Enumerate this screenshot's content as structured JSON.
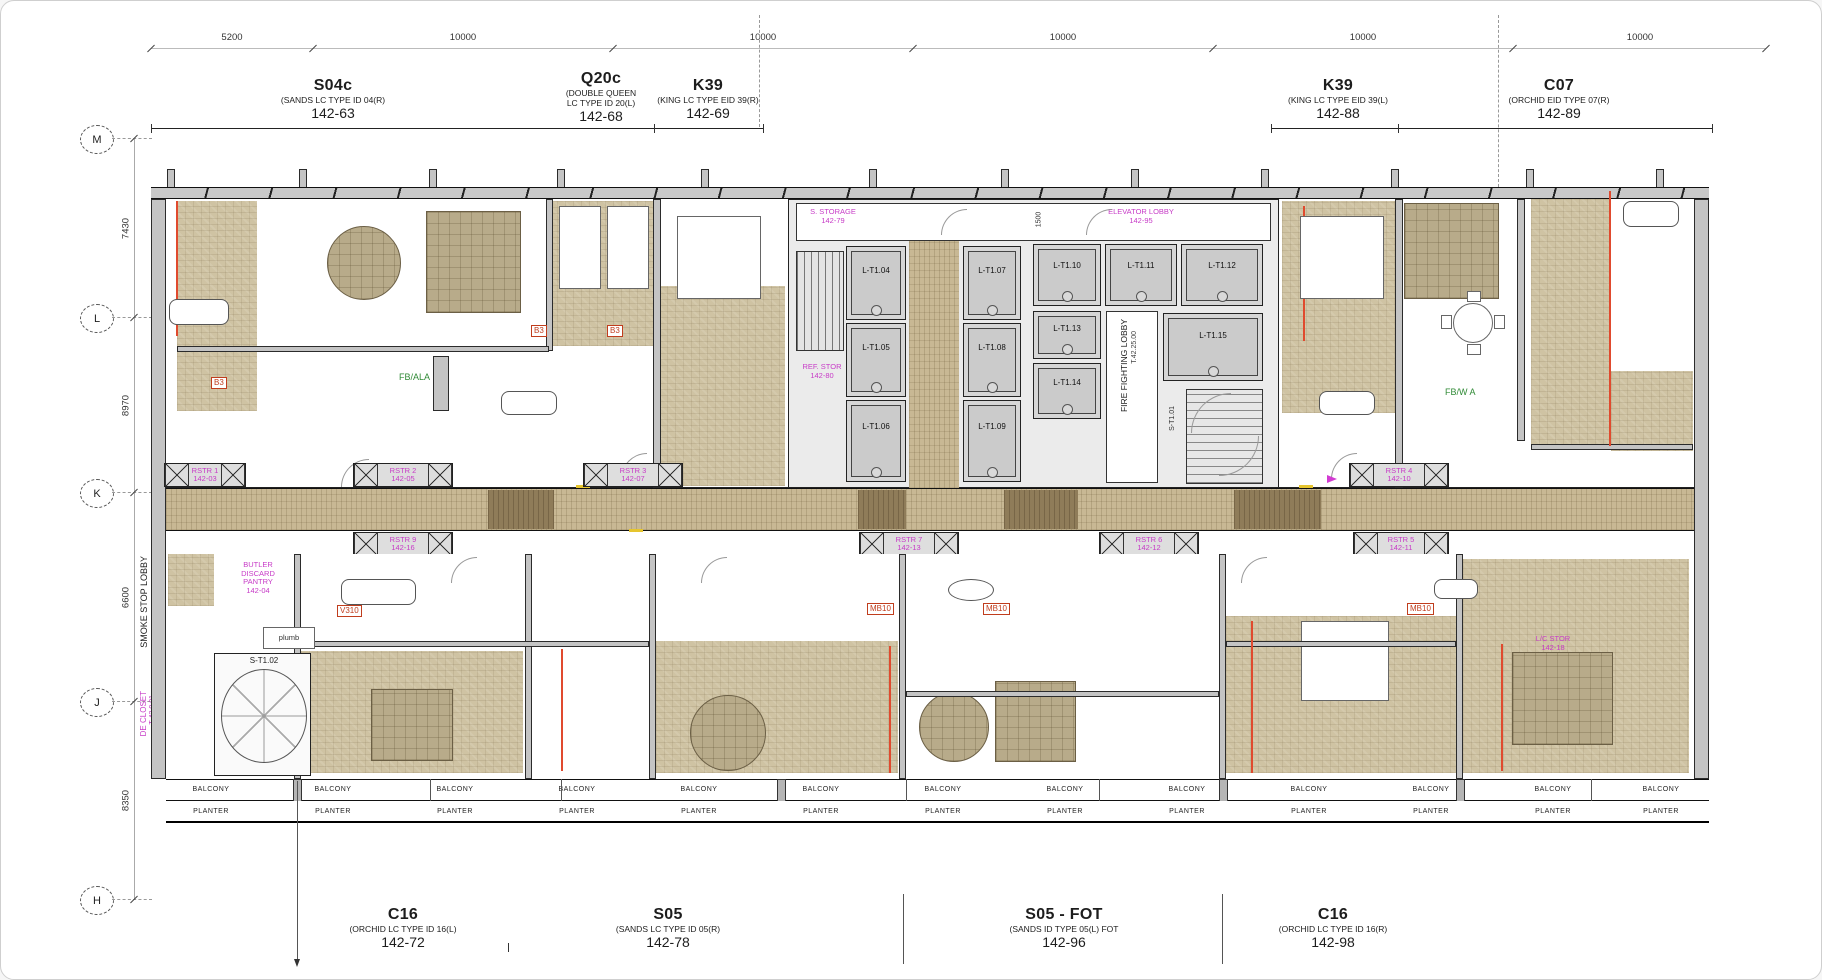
{
  "sheet": {
    "background": "#ffffff",
    "border_color": "#cfcfcf"
  },
  "palette": {
    "carpet": "#cfc3a3",
    "corridor": "#c8b894",
    "corridor_dark": "#8f7c59",
    "rug": "#b8ab8a",
    "wall_gray": "#c4c4c4",
    "red_line": "#e04a2e",
    "tag_red": "#c03d1d",
    "magenta": "#c73bc7",
    "green": "#2f8a35"
  },
  "top_dims": {
    "values": [
      "5200",
      "10000",
      "10000",
      "10000",
      "10000",
      "10000"
    ]
  },
  "left_dims": {
    "values": [
      "7430",
      "8970",
      "6600",
      "8350"
    ]
  },
  "grid": {
    "rows": [
      "M",
      "L",
      "K",
      "J",
      "H"
    ]
  },
  "units_top": [
    {
      "code": "S04c",
      "desc": "(SANDS LC TYPE ID 04(R)",
      "num": "142-63"
    },
    {
      "code": "Q20c",
      "desc": "(DOUBLE QUEEN",
      "desc2": "LC TYPE ID 20(L)",
      "num": "142-68"
    },
    {
      "code": "K39",
      "desc": "(KING LC TYPE EID 39(R)",
      "num": "142-69"
    },
    {
      "code": "K39",
      "desc": "(KING LC TYPE EID 39(L)",
      "num": "142-88"
    },
    {
      "code": "C07",
      "desc": "(ORCHID EID TYPE 07(R)",
      "num": "142-89"
    }
  ],
  "units_bottom": [
    {
      "code": "C16",
      "desc": "(ORCHID LC TYPE ID 16(L)",
      "num": "142-72"
    },
    {
      "code": "S05",
      "desc": "(SANDS LC TYPE ID 05(R)",
      "num": "142-78"
    },
    {
      "code": "S05 - FOT",
      "desc": "(SANDS ID TYPE 05(L) FOT",
      "num": "142-96"
    },
    {
      "code": "C16",
      "desc": "(ORCHID LC TYPE ID 16(R)",
      "num": "142-98"
    }
  ],
  "strips": {
    "balcony": "BALCONY",
    "planter": "PLANTER"
  },
  "risers": [
    {
      "name": "RSTR 1",
      "num": "142-03"
    },
    {
      "name": "RSTR 2",
      "num": "142-05"
    },
    {
      "name": "RSTR 3",
      "num": "142-07"
    },
    {
      "name": "RSTR 4",
      "num": "142-10"
    },
    {
      "name": "RSTR 9",
      "num": "142-16"
    },
    {
      "name": "RSTR 7",
      "num": "142-13"
    },
    {
      "name": "RSTR 6",
      "num": "142-12"
    },
    {
      "name": "RSTR 5",
      "num": "142-11"
    }
  ],
  "core": {
    "lifts": [
      "L-T1.04",
      "L-T1.05",
      "L-T1.06",
      "L-T1.07",
      "L-T1.08",
      "L-T1.09",
      "L-T1.10",
      "L-T1.11",
      "L-T1.12",
      "L-T1.13",
      "L-T1.14",
      "L-T1.15"
    ],
    "storage": "S. STORAGE",
    "storage_num": "142-79",
    "elevator_lobby": "ELEVATOR LOBBY",
    "elevator_lobby_num": "142-95",
    "fire_lobby": "FIRE FIGHTING LOBBY",
    "fire_lobby_id": "T.42.25.00",
    "ref_store": "REF. STOR",
    "ref_store_num": "142-80",
    "stair_right": "S-T1.01",
    "dim_1500": "1500"
  },
  "annotations": {
    "smoke_lobby": "SMOKE STOP LOBBY",
    "smoke_lobby_id": "T.42.22.00",
    "de_closet": "DE CLOSET",
    "de_closet_id": "T-42.0.01",
    "butler1": "BUTLER",
    "butler2": "DISCARD",
    "butler3": "PANTRY",
    "butler_num": "142-04",
    "stair_left": "S-T1.02",
    "plumb": "plumb",
    "lc_stor": "L/C STOR",
    "lc_stor_num": "142-18",
    "fb_ala": "FB/ALA",
    "fb_wa": "FB/W A",
    "b3": "B3",
    "v310": "V310",
    "mb10": "MB10"
  }
}
